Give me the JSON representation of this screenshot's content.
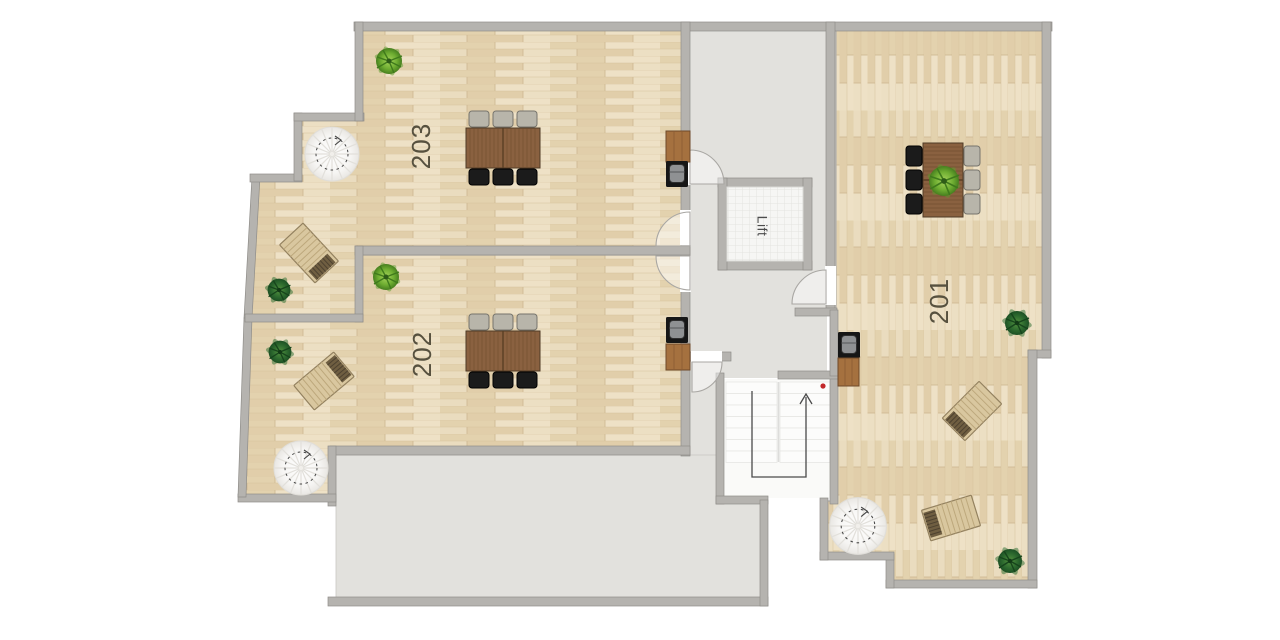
{
  "plan": {
    "apartments": {
      "a203": {
        "label": "203"
      },
      "a202": {
        "label": "202"
      },
      "a201": {
        "label": "201"
      }
    },
    "lift": {
      "label": "Lift"
    },
    "stairs": {
      "direction": "up"
    },
    "colors": {
      "wood_floor": "#e8dabc",
      "wall": "#b5b3af",
      "common_floor": "#e2e1dd",
      "stairwell_floor": "#fafaf8",
      "stair_marker_red": "#c2272a",
      "plant_light_green": "#7ab33c",
      "plant_dark_green": "#2e6b2f",
      "table_wood": "#8a6140"
    },
    "furniture_inventory": {
      "dining_tables": 3,
      "chairs": 18,
      "sun_loungers": 4,
      "plants": 7,
      "spiral_staircases": 3,
      "stoves": 3,
      "cabinets": 3,
      "main_staircases": 1
    }
  }
}
